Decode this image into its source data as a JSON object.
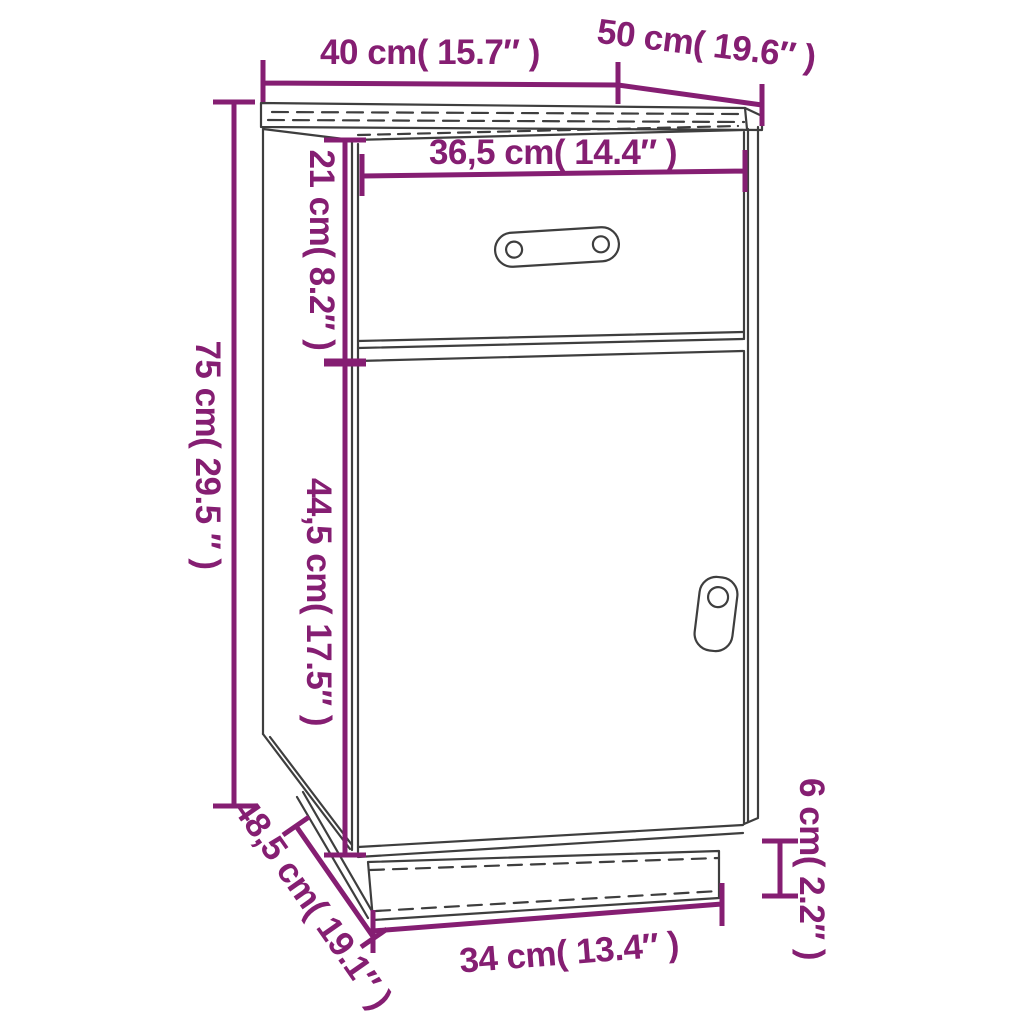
{
  "palette": {
    "dimension_color": "#851e72",
    "line_color": "#3e3e3e",
    "background": "#ffffff"
  },
  "diagram": {
    "kind": "furniture-dimension-diagram",
    "subject": "cabinet with drawer and door"
  },
  "dimensions": {
    "width_top": "40 cm( 15.7″ )",
    "depth_top": "50 cm( 19.6″ )",
    "drawer_width": "36,5 cm( 14.4″ )",
    "drawer_height": "21 cm( 8.2″ )",
    "overall_height": "75 cm( 29.5 ″ )",
    "door_height": "44,5 cm( 17.5″ )",
    "base_depth": "48,5 cm( 19.1″ )",
    "base_width": "34 cm( 13.4″ )",
    "plinth_height": "6 cm( 2.2″ )"
  }
}
